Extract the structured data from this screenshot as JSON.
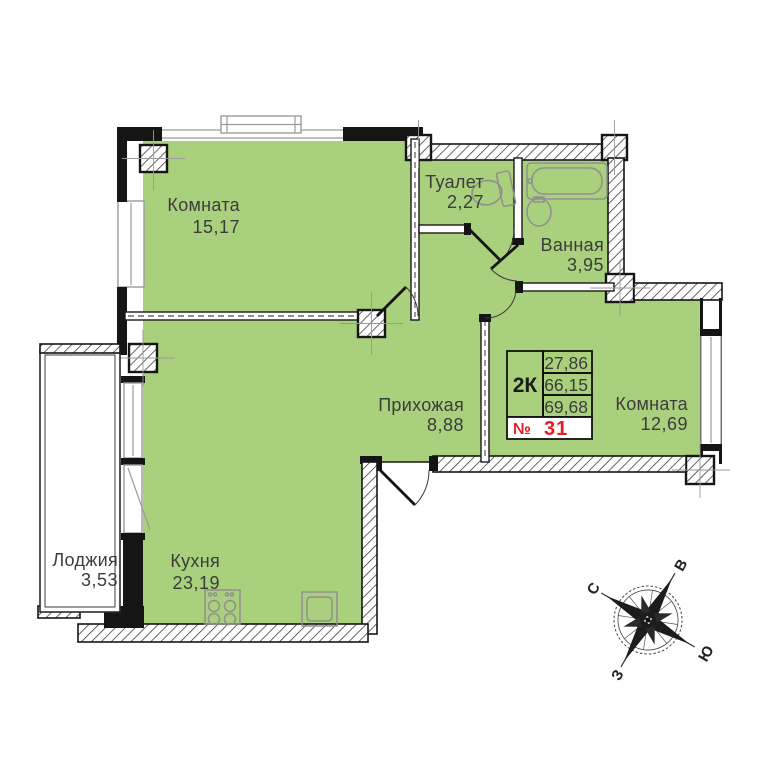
{
  "plan": {
    "rooms": [
      {
        "name": "Комната",
        "area": "15,17"
      },
      {
        "name": "Туалет",
        "area": "2,27"
      },
      {
        "name": "Ванная",
        "area": "3,95"
      },
      {
        "name": "Прихожая",
        "area": "8,88"
      },
      {
        "name": "Комната",
        "area": "12,69"
      },
      {
        "name": "Кухня",
        "area": "23,19"
      },
      {
        "name": "Лоджия",
        "area": "3,53"
      }
    ],
    "info_box": {
      "type": "2К",
      "values": [
        "27,86",
        "66,15",
        "69,68"
      ],
      "number_sign": "№",
      "number": "31"
    },
    "compass": {
      "north": "С",
      "east": "В",
      "south": "Ю",
      "west": "З"
    },
    "colors": {
      "room_fill": "#a9d07c",
      "wall": "#151515",
      "number_red": "#e31e24"
    }
  }
}
